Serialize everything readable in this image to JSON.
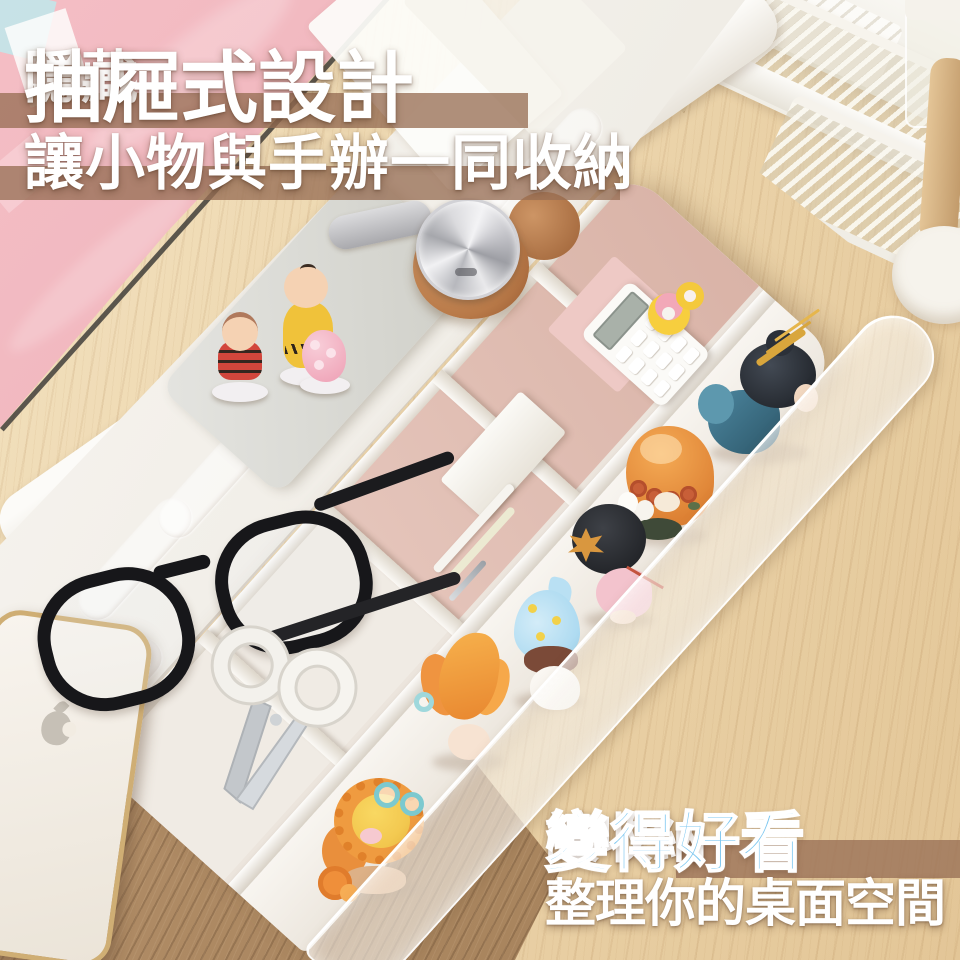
{
  "overlay": {
    "headline": {
      "prefix": "隱藏",
      "emphasis": "抽屜式設計"
    },
    "headline_line2": "讓小物與手辦一同收納",
    "tagline_prefix": "讓收納",
    "tagline_emphasis": "變得好看",
    "tagline_line2": "整理你的桌面空間",
    "colors": {
      "text_white": "#ffffff",
      "emphasis_blue": "#7cc7f0",
      "highlight_band_brown": "rgba(152,112,86,0.78)"
    }
  },
  "scene": {
    "description": "white desktop monitor-stand organizer with hidden pull-out drawer, small items and blind-box figures stored inside, on a wooden desk",
    "objects": [
      "pink pegboard with sticky notes",
      "white stacked wire shelf rack",
      "wireless headphones with tan ear cushions",
      "peanuts figurines on gray tray",
      "black rim eyeglasses",
      "white gold-frame smartphone",
      "white scissors",
      "white calculator and washi tape rolls",
      "white storage box and pens",
      "row of blind-box figurines in long drawer compartment",
      "translucent frosted drawer front",
      "wooden mug-tree pole with white base"
    ]
  }
}
